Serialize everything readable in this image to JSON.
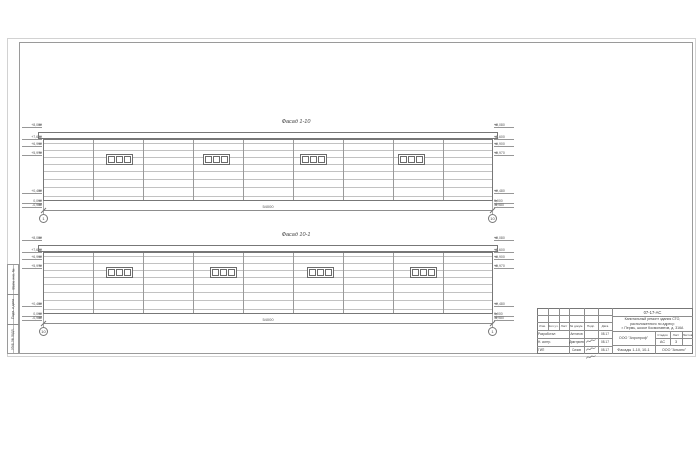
{
  "facades": [
    {
      "title": "Фасад 1-10",
      "dimension": "54000",
      "axis_left": "1",
      "axis_right": "10",
      "marks": [
        "+8,080",
        "+7,600",
        "+6,900",
        "+5,970",
        "+0,480",
        "0,000",
        "-0,980"
      ]
    },
    {
      "title": "Фасад 10-1",
      "dimension": "54000",
      "axis_left": "10",
      "axis_right": "1",
      "marks": [
        "+8,080",
        "+7,600",
        "+6,900",
        "+5,970",
        "+0,480",
        "0,000",
        "-0,980"
      ]
    }
  ],
  "titleblock": {
    "doc_number": "07-17-АС",
    "project_lines": [
      "Капитальный ремонт здания СТО,",
      "расположенного по адресу:",
      "г. Пермь, шоссе Космонавтов, д. 316А"
    ],
    "cols": [
      "Изм.",
      "Кол.уч.",
      "Лист",
      "№ докум.",
      "Подп.",
      "Дата"
    ],
    "rows": [
      {
        "role": "Разработал",
        "name": "Антонов",
        "date": "08.17"
      },
      {
        "role": "Н. контр.",
        "name": "Дмитриев",
        "date": "08.17"
      },
      {
        "role": "ГИП",
        "name": "Сизов",
        "date": "08.17"
      }
    ],
    "org_top": "ООО \"Аэропроф\"",
    "stage_label": "Стадия",
    "list_label": "Лист",
    "lists_label": "Листов",
    "stage": "АС",
    "list_no": "3",
    "lists_total": "",
    "sheet_title": "Фасады 1-10, 10-1",
    "org_bottom": "ООО \"Альянс\""
  },
  "margin_labels": [
    "Взам. инв. №",
    "Подп. и дата",
    "Инв. № подл."
  ]
}
